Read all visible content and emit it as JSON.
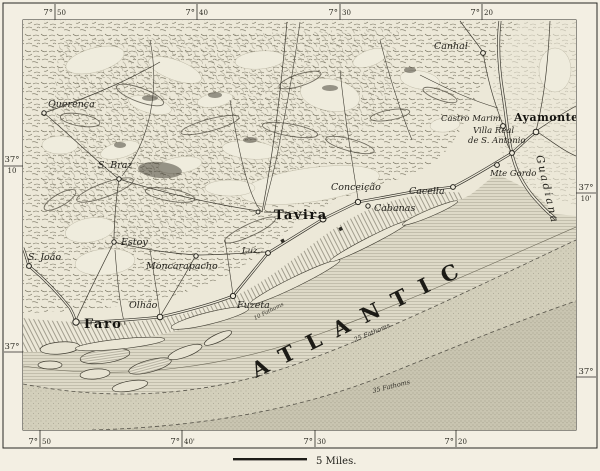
{
  "colors": {
    "paper": "#ece8d8",
    "ink": "#2b2a24",
    "sea_nearshore": "#dedac8",
    "sea_mid": "#d3cfbb",
    "sea_deep": "#c9c5b1",
    "hill_hatch": "#6e6a58"
  },
  "graticule": {
    "top": [
      {
        "deg": "7°",
        "min": "50"
      },
      {
        "deg": "7°",
        "min": "40"
      },
      {
        "deg": "7°",
        "min": "30"
      },
      {
        "deg": "7°",
        "min": "20"
      }
    ],
    "bottom": [
      {
        "deg": "7°",
        "min": "50"
      },
      {
        "deg": "7°",
        "min": "40'"
      },
      {
        "deg": "7°",
        "min": "30"
      },
      {
        "deg": "7°",
        "min": "20"
      }
    ],
    "left": [
      {
        "deg": "37°",
        "min": "10"
      },
      {
        "deg": "37°",
        "min": ""
      }
    ],
    "right": [
      {
        "deg": "37°",
        "min": "10'"
      },
      {
        "deg": "37°",
        "min": ""
      }
    ]
  },
  "ocean": {
    "label": "ATLANTIC"
  },
  "river": {
    "label": "Guadiana"
  },
  "depth_labels": [
    {
      "label": "10 Fathoms"
    },
    {
      "label": "25 Fathoms"
    },
    {
      "label": "35 Fathoms"
    }
  ],
  "places": [
    {
      "name": "Querença"
    },
    {
      "name": "S. Braz"
    },
    {
      "name": "Estoy"
    },
    {
      "name": "S. João"
    },
    {
      "name": "Moncarapacho"
    },
    {
      "name": "Olhão"
    },
    {
      "name": "Faro"
    },
    {
      "name": "Fuzeta"
    },
    {
      "name": "Luz."
    },
    {
      "name": "Tavira"
    },
    {
      "name": "Conceição"
    },
    {
      "name": "Cabanas"
    },
    {
      "name": "Cacella"
    },
    {
      "name": "Castro Marim"
    },
    {
      "name": "Villa Real",
      "name2": "de S. Antonio"
    },
    {
      "name": "Mte Gordo"
    },
    {
      "name": "Ayamonte"
    },
    {
      "name": "Canhal"
    }
  ],
  "scale": {
    "label": "5 Miles."
  }
}
